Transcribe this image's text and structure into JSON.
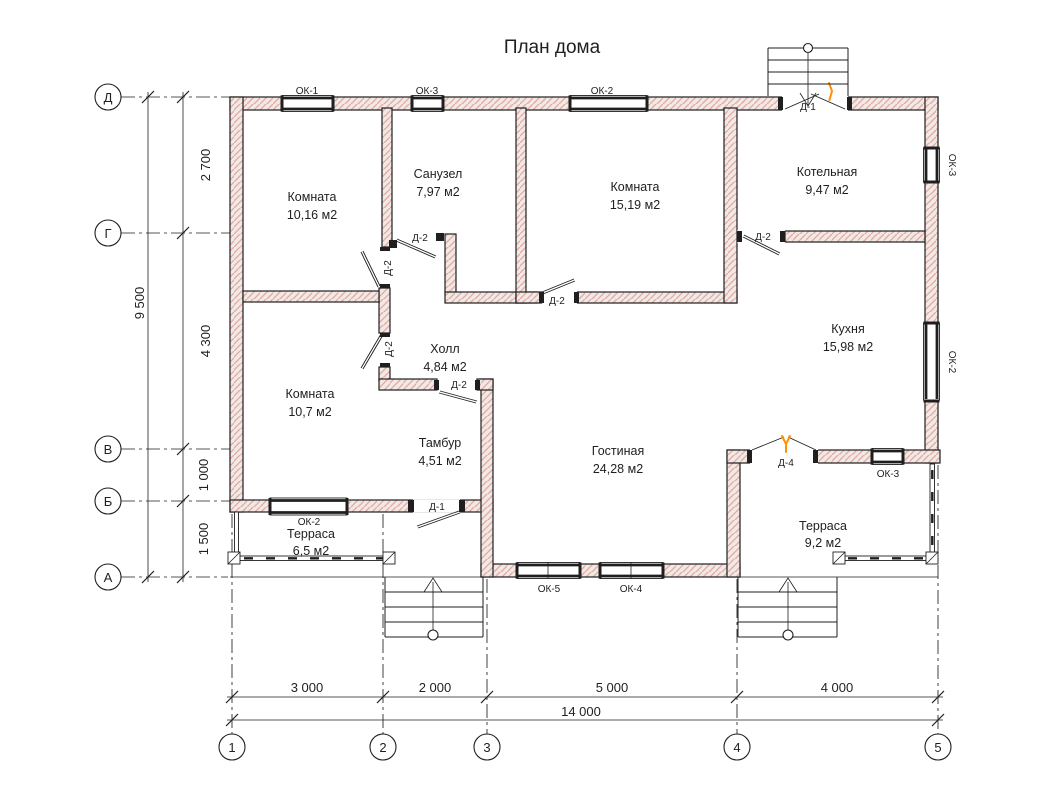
{
  "title": "План дома",
  "colors": {
    "wall_fill": "#f2e8e4",
    "wall_hatch": "#dfaaa6",
    "line": "#1f1f1f",
    "door_accent": "#ff9100"
  },
  "rooms": [
    {
      "name": "Комната",
      "area": "10,16 м2"
    },
    {
      "name": "Санузел",
      "area": "7,97 м2"
    },
    {
      "name": "Комната",
      "area": "15,19 м2"
    },
    {
      "name": "Котельная",
      "area": "9,47 м2"
    },
    {
      "name": "Кухня",
      "area": "15,98 м2"
    },
    {
      "name": "Холл",
      "area": "4,84 м2"
    },
    {
      "name": "Комната",
      "area": "10,7 м2"
    },
    {
      "name": "Тамбур",
      "area": "4,51 м2"
    },
    {
      "name": "Гостиная",
      "area": "24,28 м2"
    },
    {
      "name": "Терраса",
      "area": "6,5 м2"
    },
    {
      "name": "Терраса",
      "area": "9,2 м2"
    }
  ],
  "window_tags": {
    "ok1": "ОК-1",
    "ok2": "ОК-2",
    "ok3": "ОК-3",
    "ok4": "ОК-4",
    "ok5": "ОК-5"
  },
  "door_tags": {
    "d1": "Д-1",
    "d2": "Д-2",
    "d4": "Д-4"
  },
  "axes": {
    "rows": [
      "Д",
      "Г",
      "В",
      "Б",
      "А"
    ],
    "cols": [
      "1",
      "2",
      "3",
      "4",
      "5"
    ]
  },
  "dimensions": {
    "left_segments": [
      "2 700",
      "4 300",
      "1 000",
      "1 500"
    ],
    "left_total": "9 500",
    "bottom_segments": [
      "3 000",
      "2 000",
      "5 000",
      "4 000"
    ],
    "bottom_total": "14 000"
  }
}
